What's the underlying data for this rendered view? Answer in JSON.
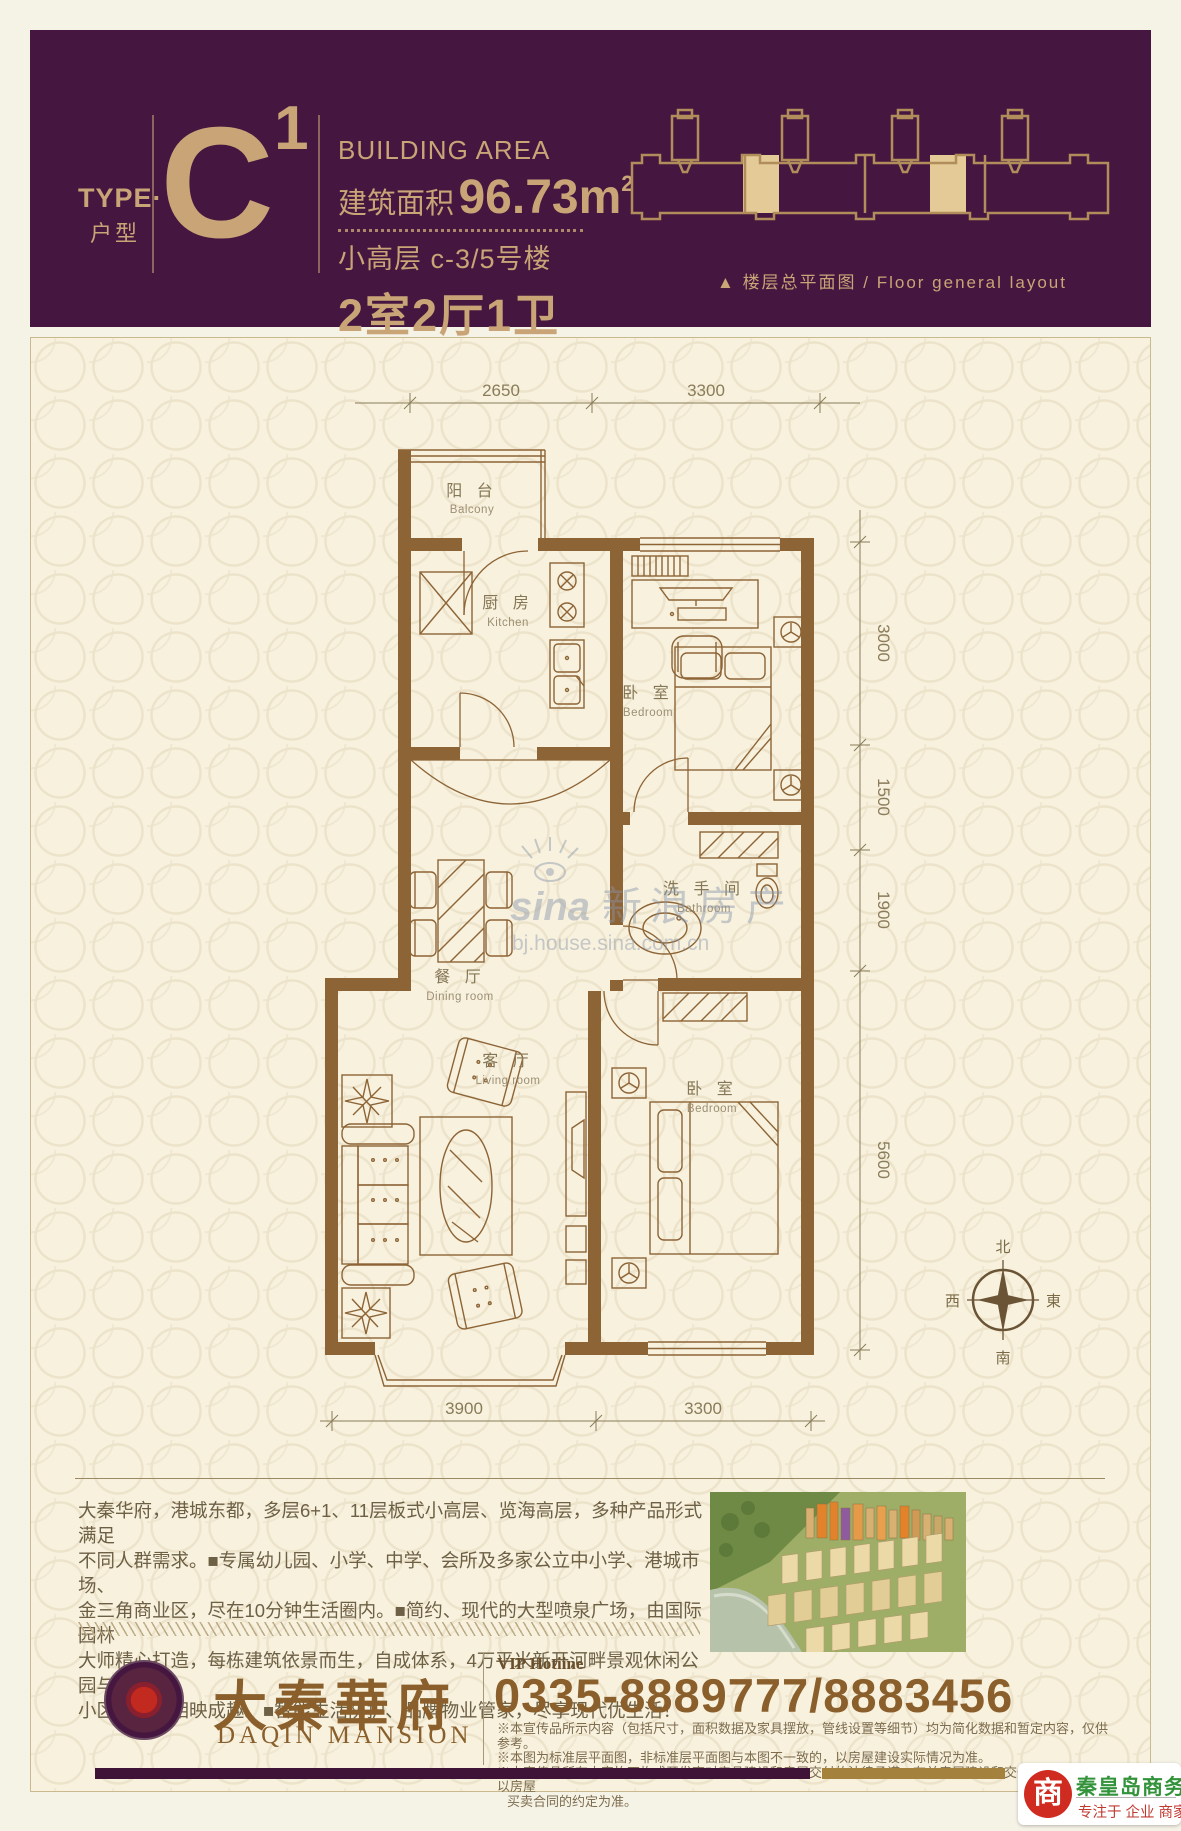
{
  "header": {
    "type_en": "TYPE·",
    "type_cn": "户型",
    "unit_letter": "C",
    "unit_sup": "1",
    "area_label": "BUILDING AREA",
    "area_prefix": "建筑面积",
    "area_value": "96.73m",
    "area_sup": "2",
    "floor_line": "小高层 c-3/5号楼",
    "rooms_line": "2室2厅1卫",
    "caption_triangle": "▲",
    "caption_text": "楼层总平面图 / Floor general layout"
  },
  "plan": {
    "rooms": [
      {
        "cn": "阳 台",
        "en": "Balcony"
      },
      {
        "cn": "厨 房",
        "en": "Kitchen"
      },
      {
        "cn": "卧 室",
        "en": "Bedroom"
      },
      {
        "cn": "洗 手 间",
        "en": "Bathroom"
      },
      {
        "cn": "餐 厅",
        "en": "Dining room"
      },
      {
        "cn": "客 厅",
        "en": "Living room"
      },
      {
        "cn": "卧 室",
        "en": "Bedroom"
      }
    ],
    "dims_top": [
      "2650",
      "3300"
    ],
    "dims_right": [
      "3000",
      "1500",
      "1900",
      "5600"
    ],
    "dims_bottom": [
      "3900",
      "3300"
    ],
    "compass": {
      "north": "北",
      "south": "南",
      "west": "西",
      "east": "東"
    },
    "watermark": {
      "brand": "sina",
      "cn": "新浪房产",
      "url": "bj.house.sina.com.cn"
    }
  },
  "footer": {
    "description_lines": [
      "大秦华府，港城东都，多层6+1、11层板式小高层、览海高层，多种产品形式满足",
      "不同人群需求。■专属幼儿园、小学、中学、会所及多家公立中小学、港城市场、",
      "金三角商业区，尽在10分钟生活圈内。■简约、现代的大型喷泉广场，由国际园林",
      "大师精心打造，每栋建筑依景而生，自成体系，4万平米新开河畔景观休闲公园与",
      "小区内园林相映成趣。■智能生活防护、品牌物业管家，尽享现代优生活！"
    ],
    "brand_cn": "大秦華府",
    "brand_en": "DAQIN MANSION",
    "vip_label": "VIP Hotiine",
    "phone": "0335-8889777/8883456",
    "disclaimer_lines": [
      "※本宣传品所示内容（包括尺寸，面积数据及家具摆放，管线设置等细节）均为简化数据和暂定内容，仅供参考。",
      "※本图为标准层平面图，非标准层平面图与本图不一致的，以房屋建设实际情况为准。",
      "※本宣传品所有内容均不构成开发商对产品建设和房屋交付的法律承诺。有关房屋建设和交付的标准及细节以房屋",
      "买卖合同的约定为准。"
    ],
    "badge": {
      "glyph": "商",
      "site": "秦皇岛商务网",
      "tagline": "专注于 企业 商家"
    }
  },
  "colors": {
    "header_purple": "#451740",
    "gold": "#c9a476",
    "wall_brown": "#8d6436",
    "panel_cream": "#f7f1de",
    "badge_red": "#d02b20",
    "badge_green": "#33933b"
  }
}
